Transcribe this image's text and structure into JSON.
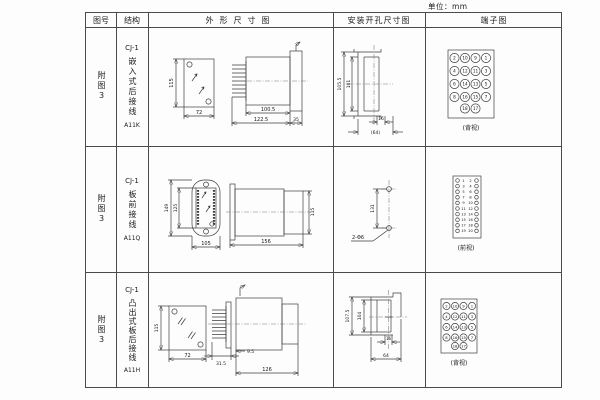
{
  "unit_label": "单位：mm",
  "table": {
    "headers": [
      "图号",
      "结构",
      "外形尺寸图",
      "安装开孔尺寸图",
      "端子图"
    ],
    "rows": [
      {
        "figure_no": "附图3",
        "model": "CJ-1",
        "mount_type": "嵌入式后接线",
        "code": "A11K",
        "outline": {
          "front_height": "115",
          "front_width": "72",
          "depth_body": "100.5",
          "depth_total": "122.5",
          "flange_depth": "35"
        },
        "install": {
          "outer_height": "105.5",
          "inner_height": "101",
          "slot_width": "16",
          "overall_width": "(64)"
        },
        "terminal": {
          "view_label": "(背视)",
          "grid": [
            [
              "2",
              "10",
              "9",
              "1"
            ],
            [
              "4",
              "12",
              "11",
              "3"
            ],
            [
              "6",
              "14",
              "13",
              "5"
            ],
            [
              "8",
              "16",
              "15",
              "7"
            ]
          ],
          "bottom": [
            "18",
            "17"
          ]
        }
      },
      {
        "figure_no": "附图3",
        "model": "CJ-1",
        "mount_type": "板前接线",
        "code": "A11Q",
        "outline": {
          "front_height": "149",
          "inner_height": "125",
          "front_width": "105",
          "depth_total": "156",
          "rear_height": "115"
        },
        "install": {
          "hole_spacing": "131",
          "hole_label": "2-Φ6"
        },
        "terminal": {
          "view_label": "(前视)",
          "pairs": [
            [
              "1",
              "2"
            ],
            [
              "3",
              "4"
            ],
            [
              "5",
              "6"
            ],
            [
              "7",
              "8"
            ],
            [
              "9",
              "10"
            ],
            [
              "11",
              "12"
            ],
            [
              "13",
              "14"
            ],
            [
              "15",
              "16"
            ],
            [
              "17",
              "18"
            ],
            [
              "19",
              "20"
            ]
          ]
        }
      },
      {
        "figure_no": "附图3",
        "model": "CJ-1",
        "mount_type": "凸出式板后接线",
        "code": "A11H",
        "outline": {
          "front_height": "115",
          "front_width": "72",
          "fin_depth": "31.5",
          "gap_depth": "9.5",
          "depth_total": "126"
        },
        "install": {
          "outer_height": "107.5",
          "inner_height": "104",
          "slot_width": "16",
          "overall_width": "64"
        },
        "terminal": {
          "view_label": "(背视)",
          "grid": [
            [
              "2",
              "10",
              "9",
              "1"
            ],
            [
              "4",
              "12",
              "11",
              "3"
            ],
            [
              "6",
              "14",
              "13",
              "5"
            ],
            [
              "8",
              "16",
              "15",
              "7"
            ]
          ],
          "bottom": [
            "18",
            "17"
          ]
        }
      }
    ]
  }
}
